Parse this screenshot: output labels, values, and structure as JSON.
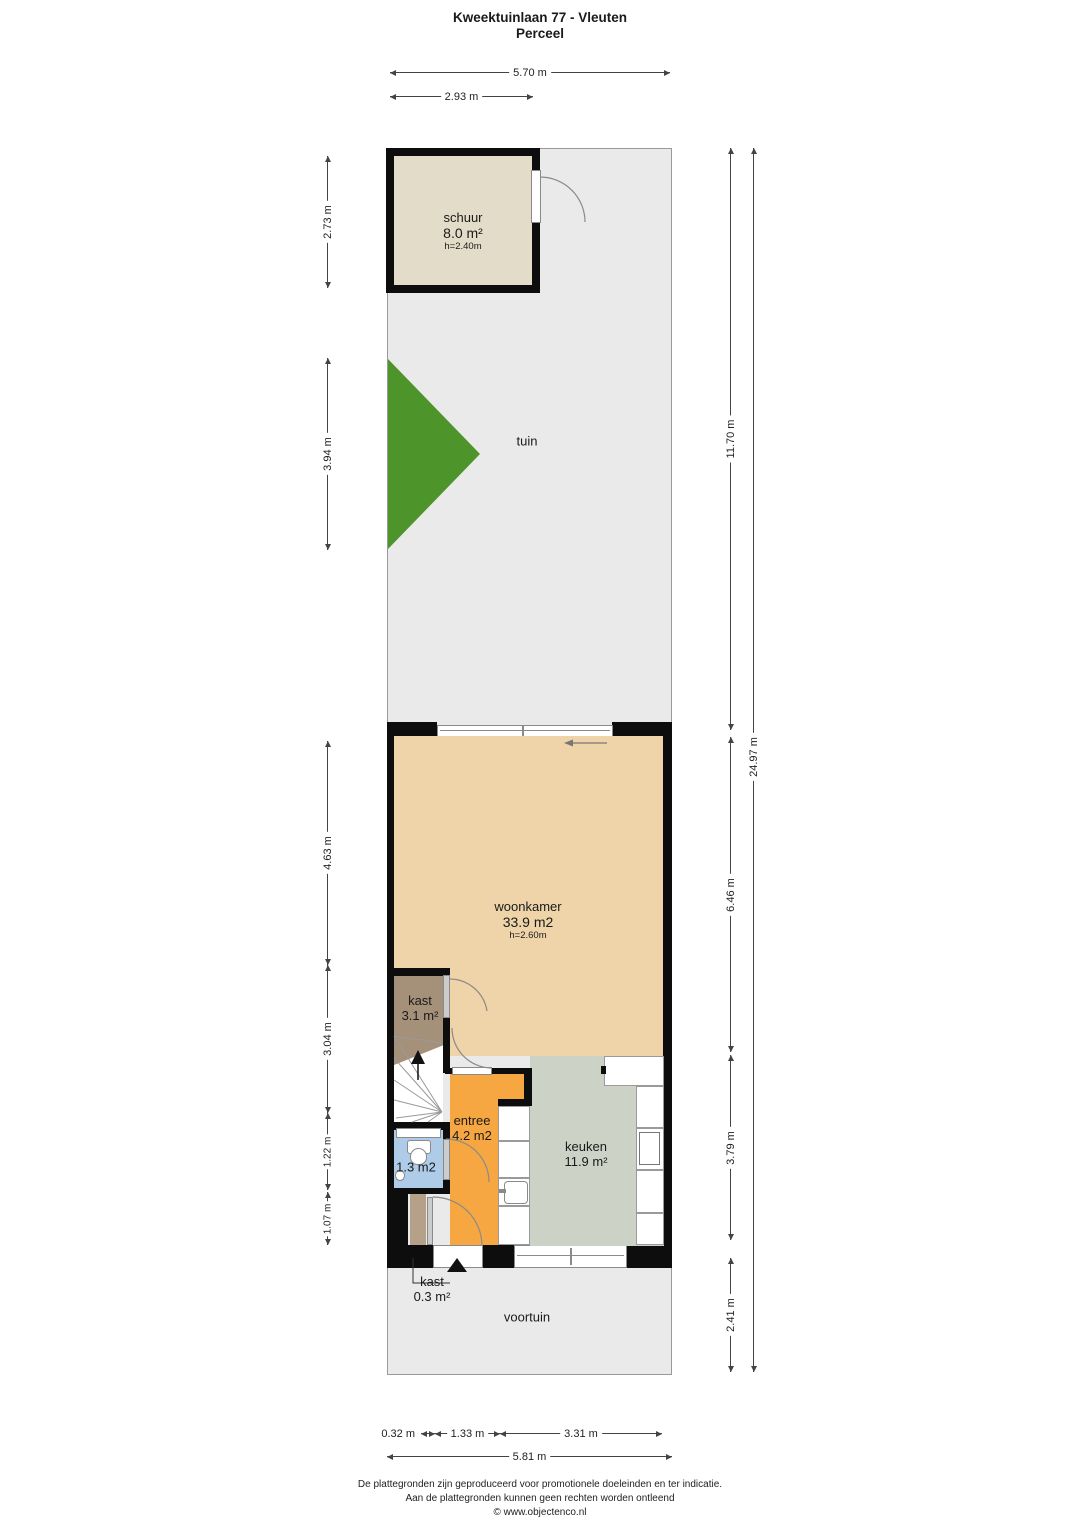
{
  "title": {
    "line1": "Kweektuinlaan 77 - Vleuten",
    "line2": "Perceel"
  },
  "rooms": {
    "schuur": {
      "name": "schuur",
      "area": "8.0 m²",
      "height": "h=2.40m"
    },
    "tuin": {
      "name": "tuin"
    },
    "woonkamer": {
      "name": "woonkamer",
      "area": "33.9 m2",
      "height": "h=2.60m"
    },
    "kast_boven": {
      "name": "kast",
      "area": "3.1 m²"
    },
    "entree": {
      "name": "entree",
      "area": "4.2 m2"
    },
    "keuken": {
      "name": "keuken",
      "area": "11.9 m²"
    },
    "toilet": {
      "area": "1.3 m2"
    },
    "kast_onder": {
      "name": "kast",
      "area": "0.3 m²"
    },
    "voortuin": {
      "name": "voortuin"
    }
  },
  "dims": {
    "top": [
      "5.70 m",
      "2.93 m"
    ],
    "left": [
      "2.73 m",
      "3.94 m",
      "4.63 m",
      "3.04 m",
      "1.22 m",
      "1.07 m"
    ],
    "right": [
      "11.70 m",
      "6.46 m",
      "3.79 m",
      "2.41 m",
      "24.97 m"
    ],
    "bottom": [
      "0.32 m",
      "1.33 m",
      "3.31 m",
      "5.81 m"
    ]
  },
  "footer": {
    "line1": "De plattegronden zijn geproduceerd voor promotionele doeleinden en ter indicatie.",
    "line2": "Aan de plattegronden kunnen geen rechten worden ontleend",
    "line3": "© www.objectenco.nl"
  },
  "colors": {
    "perceel": "#eaeaea",
    "schuur": "#e3dcc8",
    "woonkamer": "#efd4a9",
    "entree": "#f6a742",
    "keuken": "#ccd3c6",
    "toilet": "#aecbe8",
    "kast": "#a5907a",
    "kast_klein": "#b5a189",
    "tree": "#4d942b",
    "wall": "#0d0d0d"
  }
}
